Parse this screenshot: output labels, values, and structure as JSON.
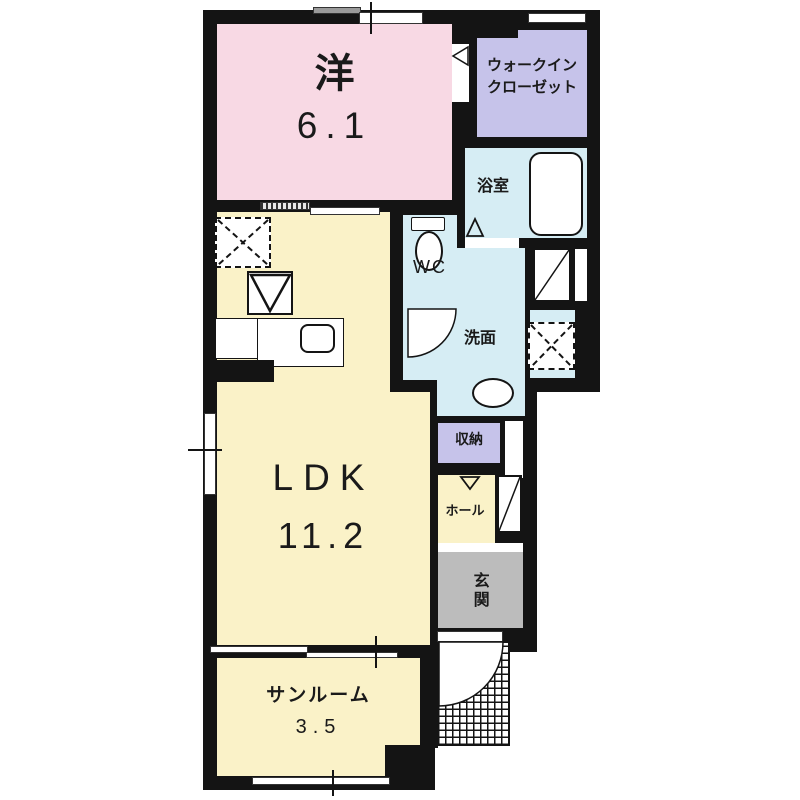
{
  "plan_title": "apartment-floor-plan",
  "rooms": {
    "western": {
      "name": "洋",
      "area": "6.1"
    },
    "wic": {
      "name1": "ウォークイン",
      "name2": "クローゼット"
    },
    "bath": {
      "name": "浴室"
    },
    "wc": {
      "name": "WC"
    },
    "washroom": {
      "name": "洗面"
    },
    "storage": {
      "name": "収納"
    },
    "hall": {
      "name": "ホール"
    },
    "entrance": {
      "name": "玄関"
    },
    "ldk": {
      "name": "LDK",
      "area": "11.2"
    },
    "sunroom": {
      "name": "サンルーム",
      "area": "3.5"
    }
  },
  "colors": {
    "wall": "#141414",
    "western_room": "#f8d9e4",
    "closet": "#c6c3ea",
    "wet_area": "#d6edf4",
    "living": "#faf2c8",
    "entrance": "#bcbcbc"
  },
  "icons": {
    "refrigerator_space": "dashed-x-square",
    "washing_machine_space": "dashed-x-square",
    "kitchen_range": "triangle-in-square",
    "kitchen_sink": "rounded-square",
    "bathtub": "rounded-rect",
    "toilet": "tank-and-bowl",
    "washbasin": "oval",
    "door_swing": "quarter-arc",
    "sliding_window": "offset-slabs",
    "porch": "crosshatch"
  }
}
